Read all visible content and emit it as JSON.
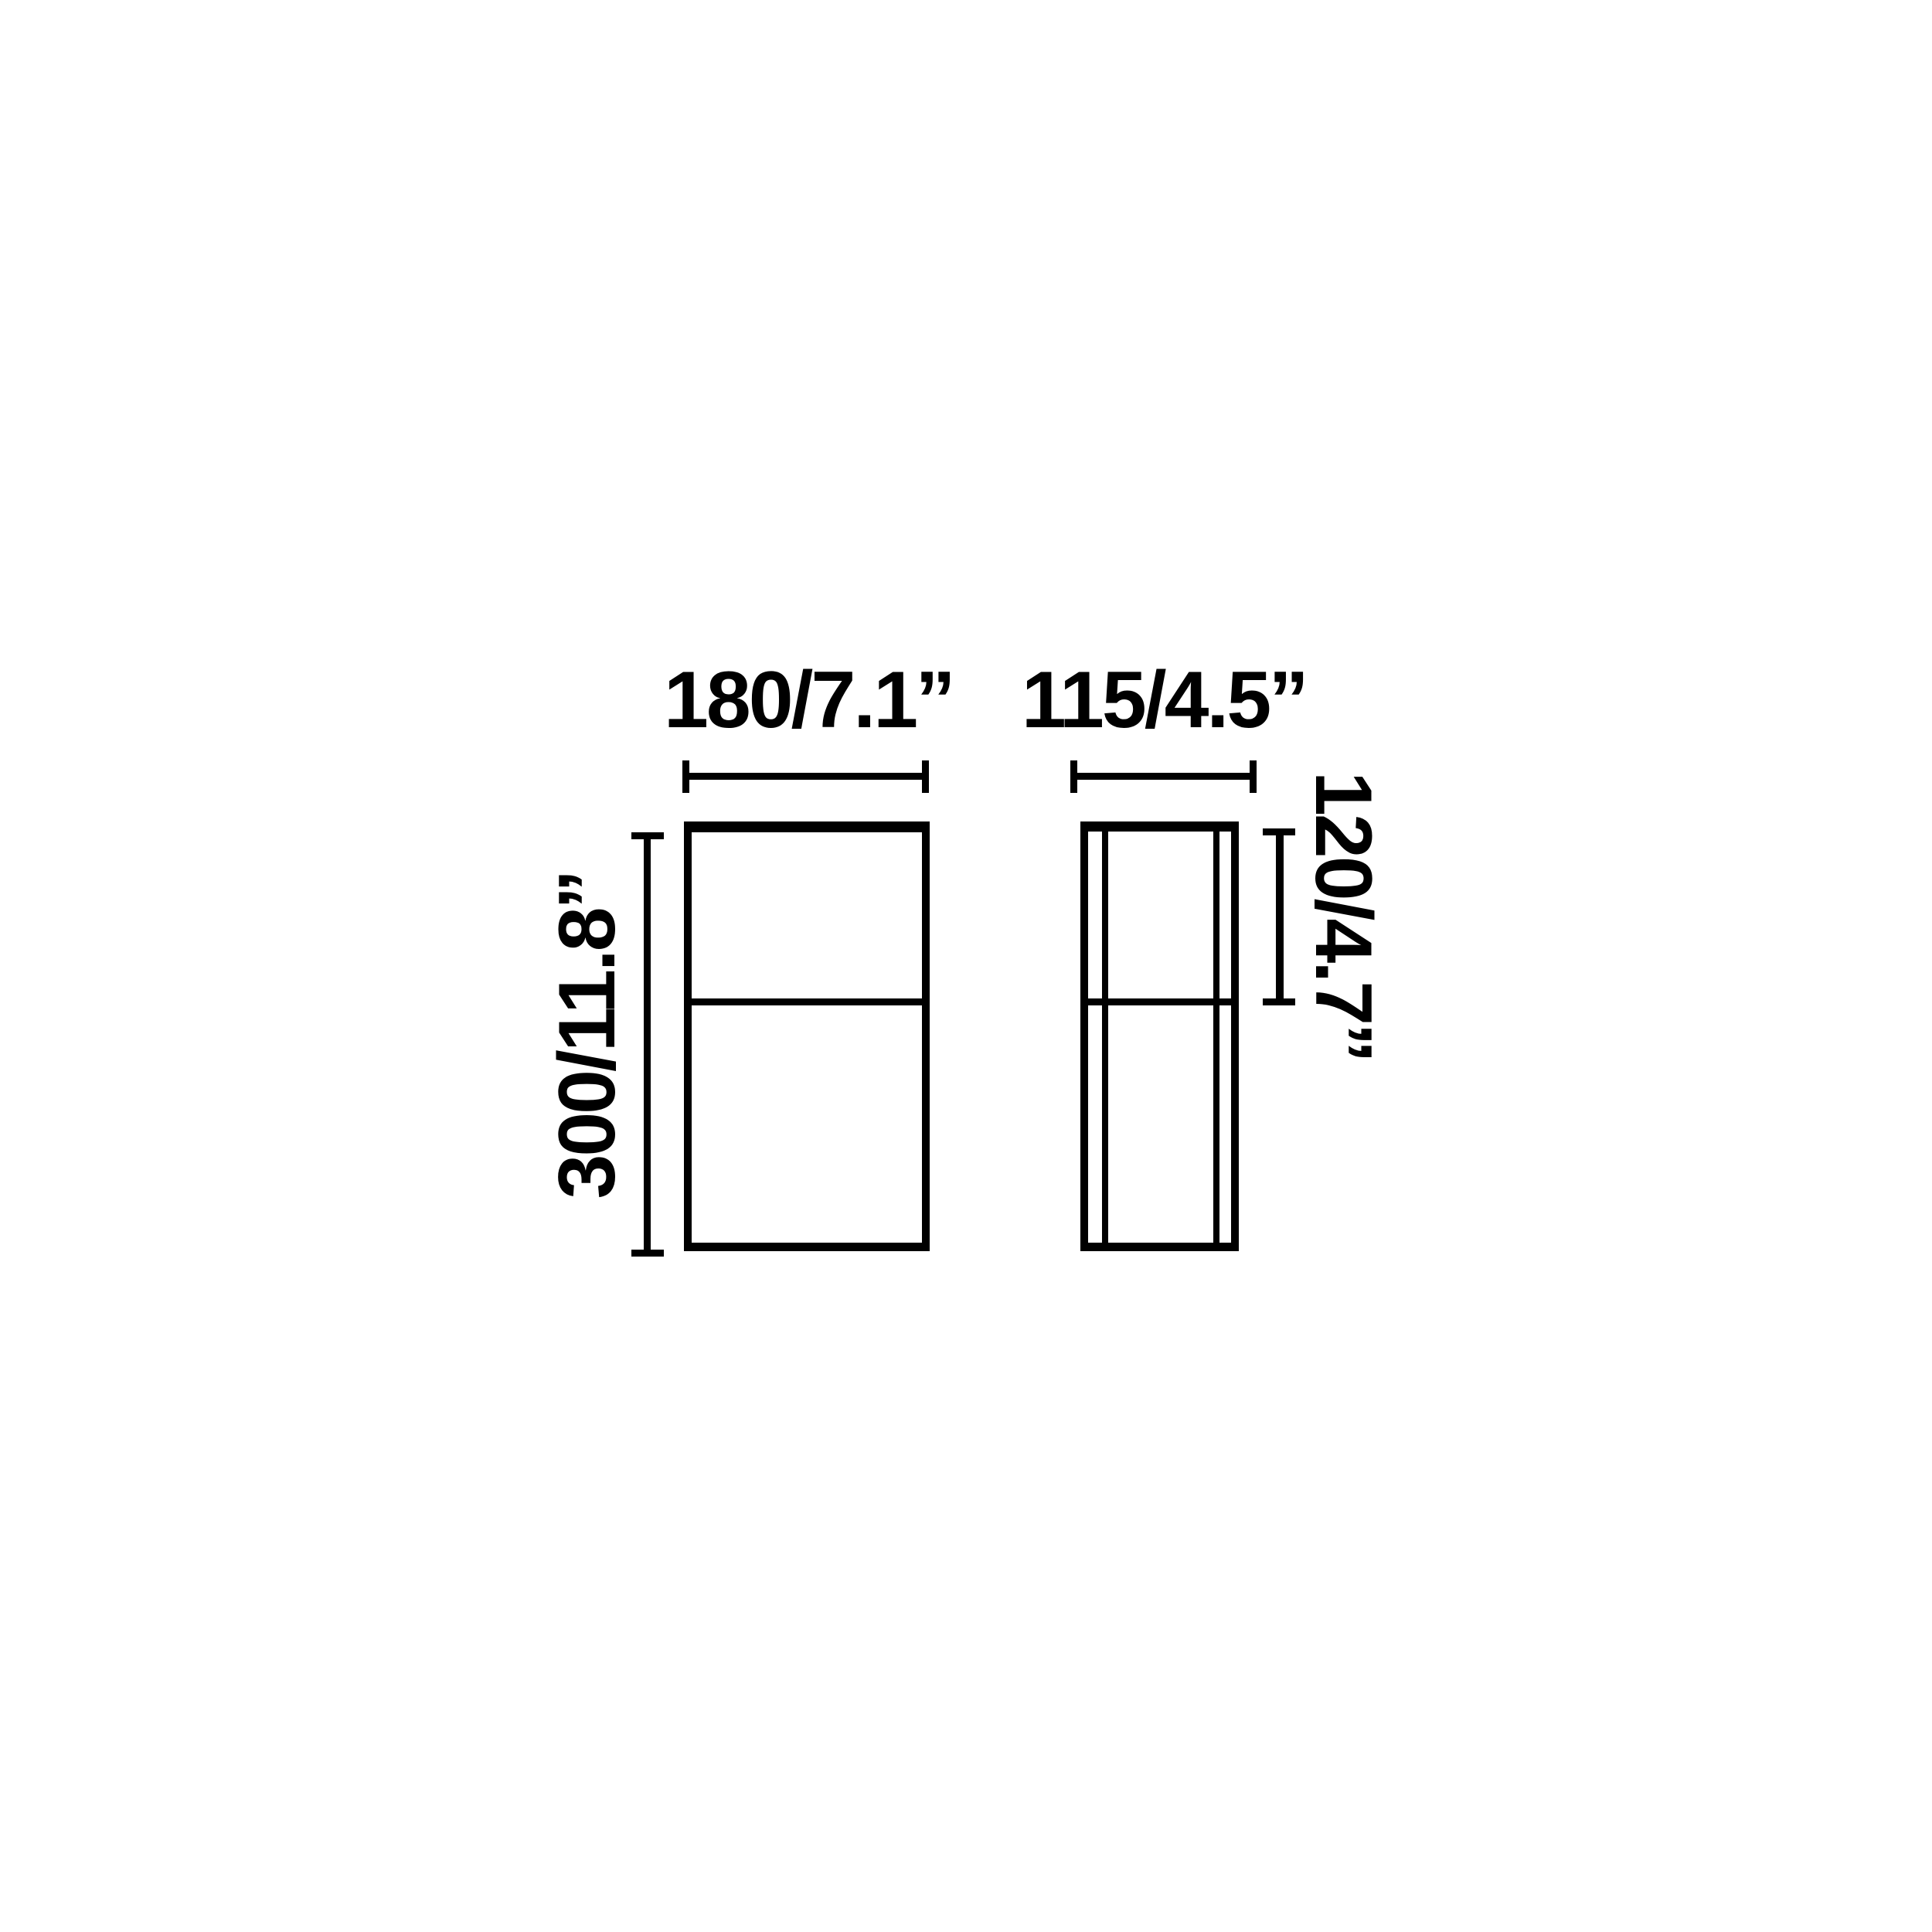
{
  "colors": {
    "background": "#ffffff",
    "line": "#000000"
  },
  "labels": {
    "front_width": "180/7.1’’",
    "side_depth": "115/4.5’’",
    "front_height": "300/11.8’’",
    "side_upper_height": "120/4.7’’"
  }
}
